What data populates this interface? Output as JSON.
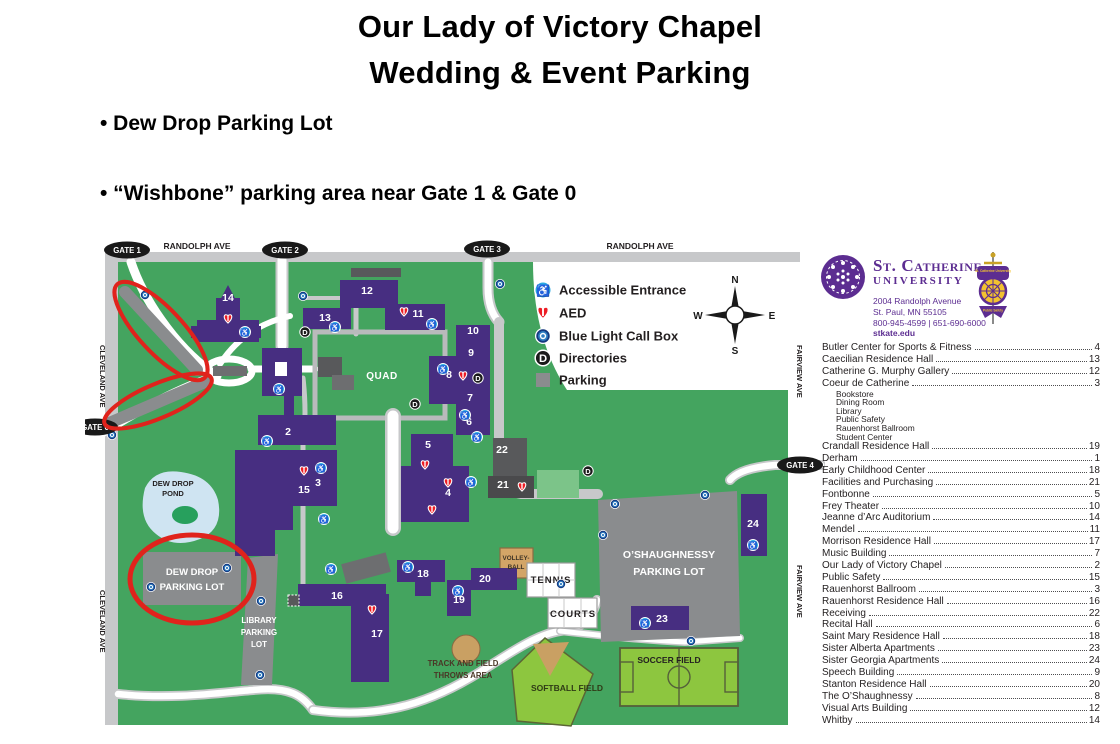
{
  "page": {
    "title_line1": "Our Lady of Victory Chapel",
    "title_line2": "Wedding & Event Parking",
    "bullet1": "• Dew Drop Parking Lot",
    "bullet2": "• “Wishbone” parking area near Gate 1 & Gate 0"
  },
  "colors": {
    "campus_green": "#44a45f",
    "building_purple": "#472e81",
    "annotation_red": "#e0231c",
    "parking_gray": "#8a8c8e",
    "accessible_blue": "#29abe2",
    "aed_red": "#ed1c24",
    "field_green": "#8dc63f",
    "brand_purple": "#5c2d91"
  },
  "map": {
    "street_labels": {
      "randolph_left": "RANDOLPH AVE",
      "randolph_right": "RANDOLPH AVE",
      "cleveland_top": "CLEVELAND AVE",
      "cleveland_bottom": "CLEVELAND AVE",
      "fairview_top": "FAIRVIEW AVE",
      "fairview_bottom": "FAIRVIEW AVE"
    },
    "gates": [
      {
        "label": "GATE 1",
        "x": 42,
        "y": 12
      },
      {
        "label": "GATE 2",
        "x": 200,
        "y": 12
      },
      {
        "label": "GATE 3",
        "x": 402,
        "y": 11
      },
      {
        "label": "GATE 0",
        "x": 10,
        "y": 189
      },
      {
        "label": "GATE 4",
        "x": 715,
        "y": 227
      }
    ],
    "building_numbers": [
      {
        "n": "1",
        "x": 197,
        "y": 135
      },
      {
        "n": "2",
        "x": 203,
        "y": 197
      },
      {
        "n": "3",
        "x": 233,
        "y": 248
      },
      {
        "n": "4",
        "x": 363,
        "y": 258
      },
      {
        "n": "5",
        "x": 343,
        "y": 210
      },
      {
        "n": "6",
        "x": 384,
        "y": 187
      },
      {
        "n": "7",
        "x": 385,
        "y": 163
      },
      {
        "n": "8",
        "x": 364,
        "y": 140
      },
      {
        "n": "9",
        "x": 386,
        "y": 118
      },
      {
        "n": "10",
        "x": 388,
        "y": 96
      },
      {
        "n": "11",
        "x": 333,
        "y": 79
      },
      {
        "n": "12",
        "x": 282,
        "y": 56
      },
      {
        "n": "13",
        "x": 240,
        "y": 83
      },
      {
        "n": "14",
        "x": 143,
        "y": 63
      },
      {
        "n": "15",
        "x": 219,
        "y": 255
      },
      {
        "n": "16",
        "x": 252,
        "y": 361
      },
      {
        "n": "17",
        "x": 292,
        "y": 399
      },
      {
        "n": "18",
        "x": 338,
        "y": 339
      },
      {
        "n": "19",
        "x": 374,
        "y": 365
      },
      {
        "n": "20",
        "x": 400,
        "y": 344
      },
      {
        "n": "21",
        "x": 418,
        "y": 250
      },
      {
        "n": "22",
        "x": 417,
        "y": 215
      },
      {
        "n": "23",
        "x": 577,
        "y": 384
      },
      {
        "n": "24",
        "x": 668,
        "y": 289
      }
    ],
    "areas": {
      "quad": "QUAD",
      "pond_line1": "DEW DROP",
      "pond_line2": "POND",
      "dewdrop_lot_line1": "DEW DROP",
      "dewdrop_lot_line2": "PARKING LOT",
      "library_lot_line1": "LIBRARY",
      "library_lot_line2": "PARKING",
      "library_lot_line3": "LOT",
      "oshaughnessy_line1": "O’SHAUGHNESSY",
      "oshaughnessy_line2": "PARKING LOT",
      "volleyball_line1": "VOLLEY-",
      "volleyball_line2": "BALL",
      "tennis_line1": "TENNIS",
      "tennis_line2": "COURTS",
      "throws_line1": "TRACK AND FIELD",
      "throws_line2": "THROWS AREA",
      "softball": "SOFTBALL FIELD",
      "soccer": "SOCCER FIELD"
    },
    "legend": [
      {
        "icon": "accessible-icon",
        "label": "Accessible Entrance"
      },
      {
        "icon": "aed-icon",
        "label": "AED"
      },
      {
        "icon": "blue-light-icon",
        "label": "Blue Light Call Box"
      },
      {
        "icon": "directories-icon",
        "label": "Directories"
      },
      {
        "icon": "parking-icon",
        "label": "Parking"
      }
    ],
    "compass": {
      "n": "N",
      "e": "E",
      "s": "S",
      "w": "W"
    },
    "icons": {
      "accessible_glyph": "♿",
      "directory_glyph": "D",
      "accessible": [
        [
          160,
          94
        ],
        [
          250,
          89
        ],
        [
          347,
          86
        ],
        [
          358,
          131
        ],
        [
          380,
          177
        ],
        [
          392,
          199
        ],
        [
          194,
          151
        ],
        [
          182,
          203
        ],
        [
          236,
          230
        ],
        [
          239,
          281
        ],
        [
          386,
          244
        ],
        [
          246,
          331
        ],
        [
          323,
          329
        ],
        [
          373,
          353
        ],
        [
          560,
          385
        ],
        [
          668,
          307
        ]
      ],
      "aed": [
        [
          143,
          81
        ],
        [
          319,
          74
        ],
        [
          378,
          138
        ],
        [
          340,
          227
        ],
        [
          363,
          245
        ],
        [
          347,
          272
        ],
        [
          219,
          233
        ],
        [
          437,
          249
        ],
        [
          287,
          372
        ]
      ],
      "callbox": [
        [
          60,
          57
        ],
        [
          218,
          58
        ],
        [
          415,
          46
        ],
        [
          27,
          197
        ],
        [
          142,
          330
        ],
        [
          66,
          349
        ],
        [
          176,
          363
        ],
        [
          175,
          437
        ],
        [
          530,
          266
        ],
        [
          620,
          257
        ],
        [
          518,
          297
        ],
        [
          476,
          346
        ],
        [
          606,
          403
        ]
      ],
      "directory": [
        [
          220,
          94
        ],
        [
          393,
          140
        ],
        [
          330,
          166
        ],
        [
          503,
          233
        ]
      ]
    }
  },
  "sidebar": {
    "university": {
      "name_line1": "St. Catherine",
      "name_line2": "University",
      "address1": "2004 Randolph Avenue",
      "address2": "St. Paul, MN 55105",
      "phone": "800-945-4599  |  651-690-6000",
      "web": "stkate.edu"
    },
    "badge": {
      "line1": "St. Catherine University",
      "line2": "Public Safety"
    },
    "directory": [
      {
        "name": "Butler Center for Sports & Fitness",
        "page": "4"
      },
      {
        "name": "Caecilian Residence Hall",
        "page": "13"
      },
      {
        "name": "Catherine G. Murphy Gallery",
        "page": "12"
      },
      {
        "name": "Coeur de Catherine",
        "page": "3",
        "sub": [
          "Bookstore",
          "Dining Room",
          "Library",
          "Public Safety",
          "Rauenhorst Ballroom",
          "Student Center"
        ]
      },
      {
        "name": "Crandall Residence Hall",
        "page": "19"
      },
      {
        "name": "Derham",
        "page": "1"
      },
      {
        "name": "Early Childhood Center",
        "page": "18"
      },
      {
        "name": "Facilities and Purchasing",
        "page": "21"
      },
      {
        "name": "Fontbonne",
        "page": "5"
      },
      {
        "name": "Frey Theater",
        "page": "10"
      },
      {
        "name": "Jeanne d’Arc Auditorium",
        "page": "14"
      },
      {
        "name": "Mendel",
        "page": "11"
      },
      {
        "name": "Morrison Residence Hall",
        "page": "17"
      },
      {
        "name": "Music Building",
        "page": "7"
      },
      {
        "name": "Our Lady of Victory Chapel",
        "page": "2"
      },
      {
        "name": "Public Safety",
        "page": "15"
      },
      {
        "name": "Rauenhorst Ballroom",
        "page": "3"
      },
      {
        "name": "Rauenhorst Residence Hall",
        "page": "16"
      },
      {
        "name": "Receiving",
        "page": "22"
      },
      {
        "name": "Recital Hall",
        "page": "6"
      },
      {
        "name": "Saint Mary Residence Hall",
        "page": "18"
      },
      {
        "name": "Sister Alberta Apartments",
        "page": "23"
      },
      {
        "name": "Sister Georgia Apartments",
        "page": "24"
      },
      {
        "name": "Speech Building",
        "page": "9"
      },
      {
        "name": "Stanton Residence Hall",
        "page": "20"
      },
      {
        "name": "The O’Shaughnessy",
        "page": "8"
      },
      {
        "name": "Visual Arts Building",
        "page": "12"
      },
      {
        "name": "Whitby",
        "page": "14"
      }
    ]
  }
}
